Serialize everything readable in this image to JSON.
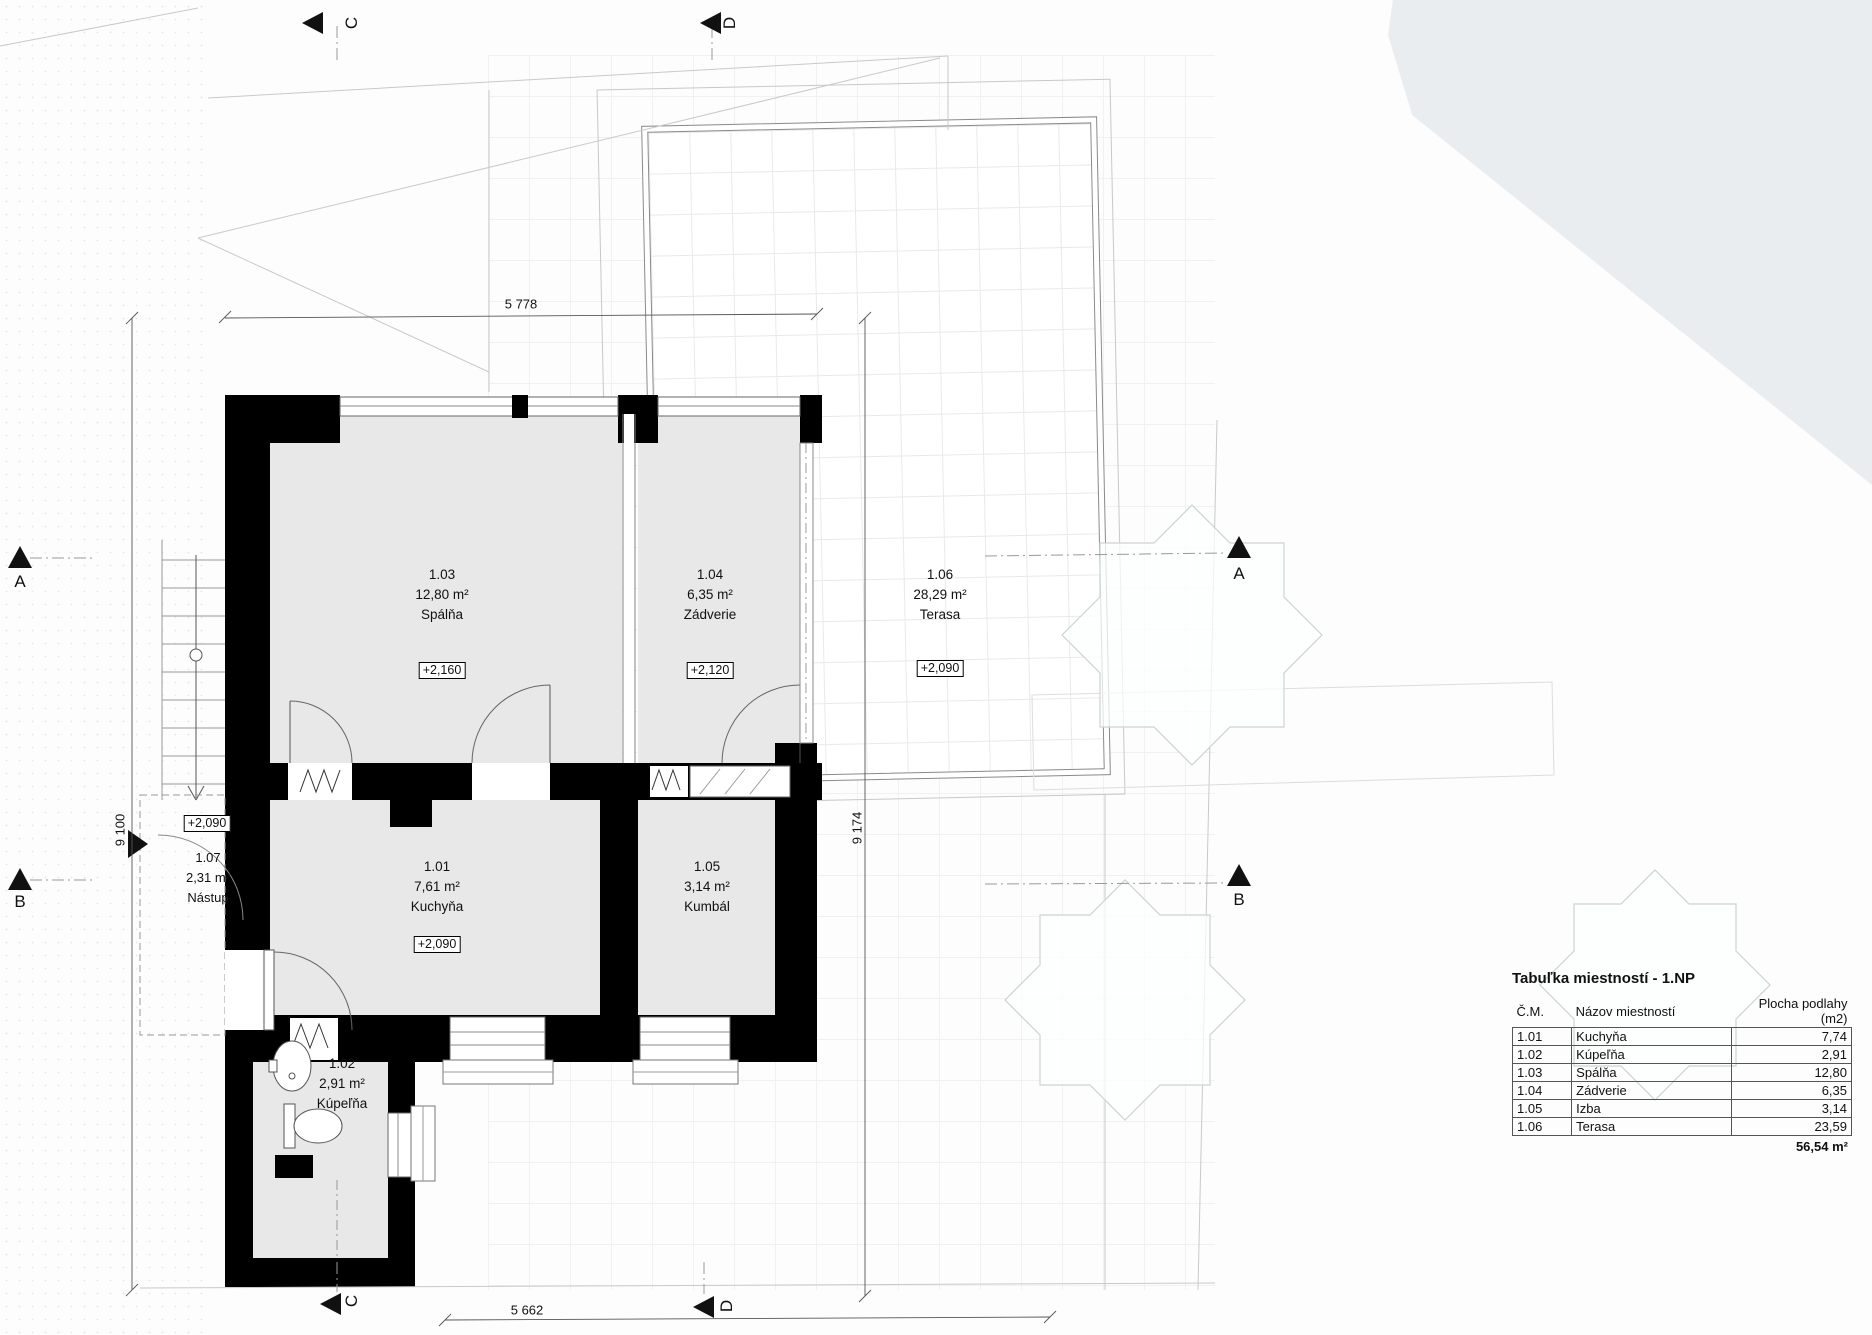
{
  "plan": {
    "rooms": [
      {
        "id": "1.01",
        "area": "7,61 m²",
        "name": "Kuchyňa",
        "elevation": "+2,090"
      },
      {
        "id": "1.02",
        "area": "2,91 m²",
        "name": "Kúpeľňa"
      },
      {
        "id": "1.03",
        "area": "12,80 m²",
        "name": "Spálňa",
        "elevation": "+2,160"
      },
      {
        "id": "1.04",
        "area": "6,35 m²",
        "name": "Zádverie",
        "elevation": "+2,120"
      },
      {
        "id": "1.05",
        "area": "3,14 m²",
        "name": "Kumbál"
      },
      {
        "id": "1.06",
        "area": "28,29 m²",
        "name": "Terasa",
        "elevation": "+2,090"
      },
      {
        "id": "1.07",
        "area": "2,31 m²",
        "name": "Nástup",
        "elevation": "+2,090"
      }
    ],
    "dimensions": {
      "top": "5 778",
      "left": "9 100",
      "right": "9 174",
      "bottom": "5 662"
    },
    "sections": {
      "a": "A",
      "b": "B",
      "c": "C",
      "d": "D"
    }
  },
  "table": {
    "title": "Tabuľka miestností - 1.NP",
    "columns": [
      "Č.M.",
      "Názov miestností",
      "Plocha podlahy (m2)"
    ],
    "rows": [
      [
        "1.01",
        "Kuchyňa",
        "7,74"
      ],
      [
        "1.02",
        "Kúpeľňa",
        "2,91"
      ],
      [
        "1.03",
        "Spálňa",
        "12,80"
      ],
      [
        "1.04",
        "Zádverie",
        "6,35"
      ],
      [
        "1.05",
        "Izba",
        "3,14"
      ],
      [
        "1.06",
        "Terasa",
        "23,59"
      ]
    ],
    "total": "56,54 m²"
  },
  "colors": {
    "wall": "#000000",
    "room_fill": "#e8e8e8",
    "site_region": "#e9edef",
    "grid_line": "#ececec"
  }
}
